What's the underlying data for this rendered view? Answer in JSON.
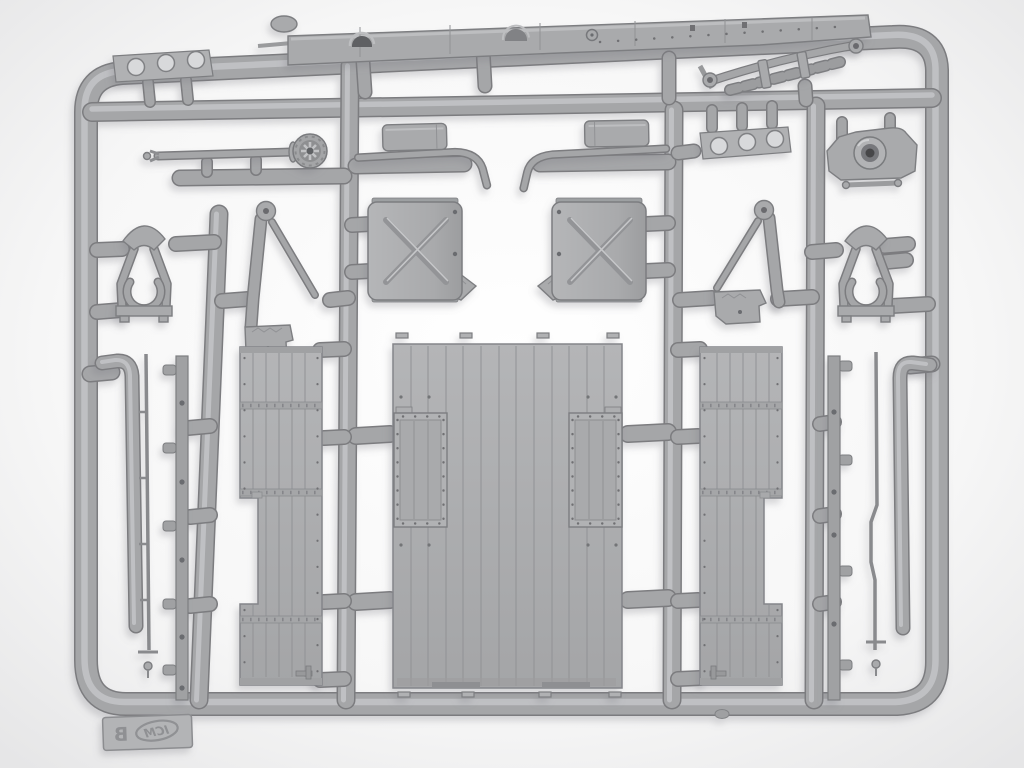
{
  "scene": {
    "description": "Photograph of a gray injection-molded polystyrene model-kit sprue (runner frame B) holding truck parts on a light background",
    "brand_mark": "ICM",
    "sprue_letter": "B",
    "palette": {
      "background": "#efefef",
      "plastic": "#a8a9ab",
      "plastic_light": "#c6c7c9",
      "plastic_dark": "#7d7e81",
      "hole_dark": "#6b6c6f",
      "panel": "#aeafb1"
    }
  },
  "parts": [
    {
      "id": "chassis-rail",
      "label": "ladder chassis side rail"
    },
    {
      "id": "leaf-spring",
      "label": "leaf spring assembly"
    },
    {
      "id": "bracket-plate-left",
      "label": "three-hole mounting plate (left)"
    },
    {
      "id": "steering-shaft",
      "label": "shaft with ribbed pulley hub"
    },
    {
      "id": "exhaust-left",
      "label": "exhaust muffler with bent tailpipe (left)"
    },
    {
      "id": "exhaust-right",
      "label": "exhaust muffler with bent tailpipe (right)"
    },
    {
      "id": "bracket-plate-right",
      "label": "three-hole mounting plate (right)"
    },
    {
      "id": "axle-housing",
      "label": "axle housing with hub boss"
    },
    {
      "id": "jerrycan-left",
      "label": "jerry can body with X emboss (left)"
    },
    {
      "id": "jerrycan-right",
      "label": "jerry can body with X emboss (right)"
    },
    {
      "id": "a-frame-left",
      "label": "A-frame bracket with clamp ring (left)"
    },
    {
      "id": "jack-arm-left",
      "label": "triangular jack strut (left)"
    },
    {
      "id": "jack-arm-right",
      "label": "triangular jack strut (right)"
    },
    {
      "id": "a-frame-right",
      "label": "A-frame bracket with clamp ring (right)"
    },
    {
      "id": "cargo-floor",
      "label": "planked cargo bed floor panel"
    },
    {
      "id": "hatch-panel-left",
      "label": "riveted hatch panel (left)"
    },
    {
      "id": "hatch-panel-right",
      "label": "riveted hatch panel (right)"
    },
    {
      "id": "bed-side-left",
      "label": "planked bed side panel with notch (left)"
    },
    {
      "id": "bed-side-right",
      "label": "planked bed side panel with notch (right)"
    },
    {
      "id": "bent-tube-left",
      "label": "long bent tube (left)"
    },
    {
      "id": "tie-rod-left",
      "label": "thin tie rod (left)"
    },
    {
      "id": "tabbed-rail-left",
      "label": "flat tabbed rail with holes (left)"
    },
    {
      "id": "bent-tube-right",
      "label": "long bent tube (right)"
    },
    {
      "id": "tie-rod-right",
      "label": "thin tie rod with kink (right)"
    },
    {
      "id": "tabbed-rail-right",
      "label": "flat tabbed rail with holes (right)"
    },
    {
      "id": "sprue-tag",
      "label": "embossed sprue identification tag"
    }
  ]
}
